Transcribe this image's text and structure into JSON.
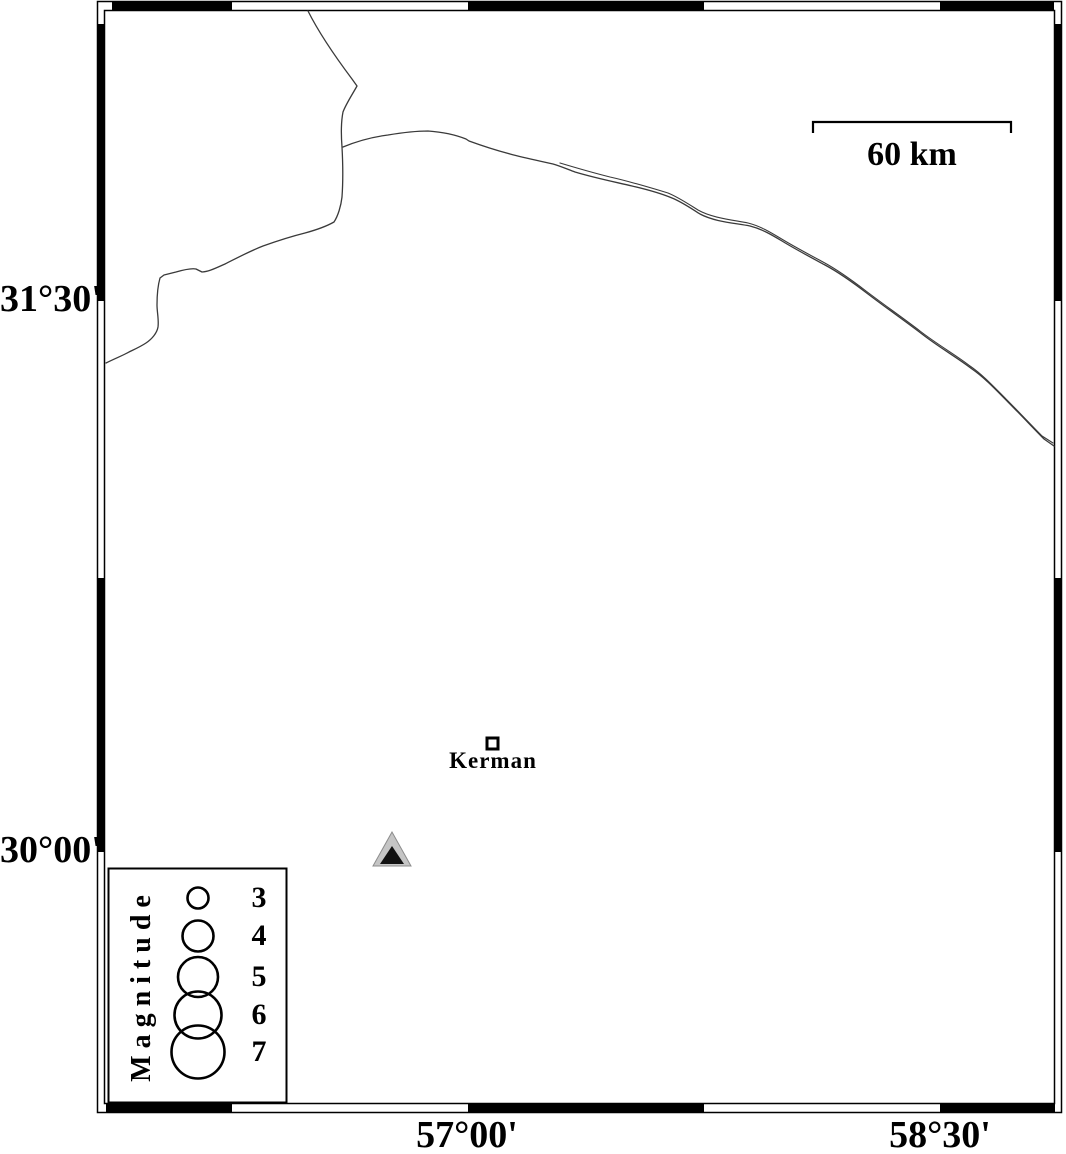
{
  "map": {
    "axes": {
      "left_labels": [
        "31°30'",
        "30°00'"
      ],
      "bottom_labels": [
        "57°00'",
        "58°30'"
      ]
    },
    "scale_bar": {
      "label": "60 km"
    },
    "city": {
      "name": "Kerman",
      "marker": "open-square"
    },
    "station": {
      "marker": "filled-triangle"
    },
    "legend": {
      "title": "Magnitude",
      "items": [
        {
          "magnitude": "3",
          "radius": 10.5
        },
        {
          "magnitude": "4",
          "radius": 15.5
        },
        {
          "magnitude": "5",
          "radius": 20
        },
        {
          "magnitude": "6",
          "radius": 23.5
        },
        {
          "magnitude": "7",
          "radius": 26.5
        }
      ]
    },
    "colors": {
      "ink": "#000000",
      "line": "#3a3a3a",
      "station_fill": "#c5c5c5",
      "station_inner": "#111111"
    }
  }
}
